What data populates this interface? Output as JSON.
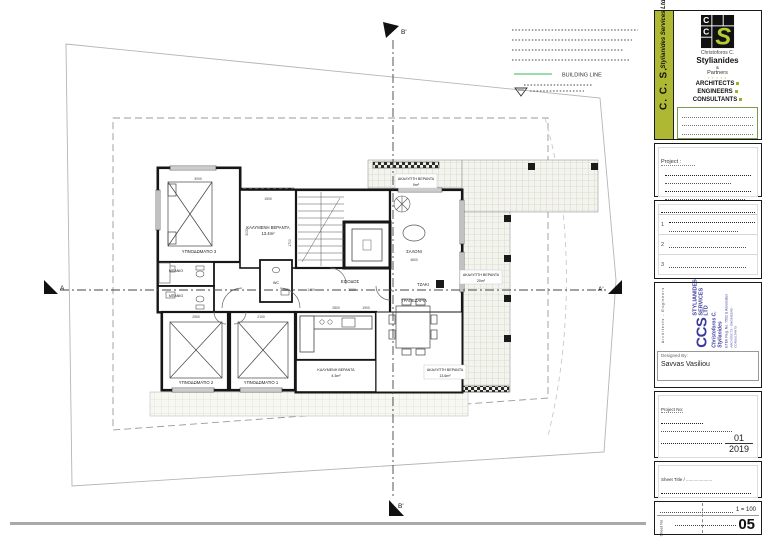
{
  "colors": {
    "accent_green": "#aeb832",
    "stamp_blue": "#3a3a9e",
    "building_line_green": "#7ccf8e"
  },
  "legend": {
    "building_line_label": "BUILDING LINE"
  },
  "section_markers": {
    "top": "B'",
    "bottom": "B'",
    "left": "A",
    "right": "A'"
  },
  "plan": {
    "rooms": {
      "bedroom3": "ΥΠΝΟΔΩΜΑΤΙΟ 3",
      "covered_veranda_top": "ΚΑΛΥΜΕΝΗ ΒΕΡΑΝΤΑ",
      "covered_veranda_top_area": "13.4m²",
      "living": "ΣΑΛΟΝΙ",
      "fireplace": "ΤΖΑΚΙ",
      "entrance": "ΕΙΣΟΔΟΣ",
      "bath1": "ΜΠΑΝΙΟ",
      "bath2": "ΜΠΑΝΙΟ",
      "wc": "WC",
      "bedroom2": "ΥΠΝΟΔΩΜΑΤΙΟ 2",
      "bedroom1": "ΥΠΝΟΔΩΜΑΤΙΟ 1",
      "dining": "ΤΡΑΠΕΖΑΡΙΑ",
      "covered_veranda_bottom": "ΚΑΛΥΜΕΝΗ ΒΕΡΑΝΤΑ",
      "covered_veranda_bottom_area": "4.3m²",
      "open_veranda_right": "ΑΚΑΛΥΠΤΗ ΒΕΡΑΝΤΑ",
      "open_veranda_right_area": "13.6m²",
      "open_veranda_top": "ΑΚΑΛΥΠΤΗ ΒΕΡΑΝΤΑ",
      "open_veranda_top_area": "9m²",
      "open_veranda_east": "ΑΚΑΛΥΠΤΗ ΒΕΡΑΝΤΑ",
      "open_veranda_east_area": "20m²"
    },
    "dimensions": [
      "3000",
      "1500",
      "3030",
      "4600",
      "2800",
      "2550",
      "2100",
      "2000",
      "1400",
      "900",
      "1700",
      "1900"
    ]
  },
  "titleblock": {
    "logo_box": {
      "bar_big": "C. C. S.",
      "bar_small": "Stylianides Services Ltd",
      "name_top": "Christoforos C.",
      "name_main": "Stylianides",
      "amp": "&",
      "partners": "Partners",
      "stars": "▪ ▪ ▪ ▪ ▪",
      "roles": [
        "ARCHITECTS",
        "ENGINEERS",
        "CONSULTANTS"
      ]
    },
    "project_box_label": "Project :",
    "revisions": {
      "rows": [
        "1",
        "2",
        "3"
      ]
    },
    "stamp": {
      "side_text": "Architects - Engineers",
      "ccs": "CCS",
      "l1a": "STYLIANIDES",
      "l1b": "SERVICES LTD",
      "l2": "Christoforos C. Stylianides",
      "l3": "ETEK Reg. No. 7502 & Associates",
      "l4": "ARCHITECTS - ENGINEERS - CONSULTANTS"
    },
    "designed_by_label": "Designed By:",
    "designed_by_value": "Savvas Vasiliou",
    "project_no_label": "Project No:",
    "project_no_number": "01",
    "project_no_year": "2019",
    "sheet_title_label": "Sheet Title / .....................",
    "scale_value": "1 = 100",
    "sheet_no_label": "Sheet No",
    "sheet_no_value": "05"
  }
}
